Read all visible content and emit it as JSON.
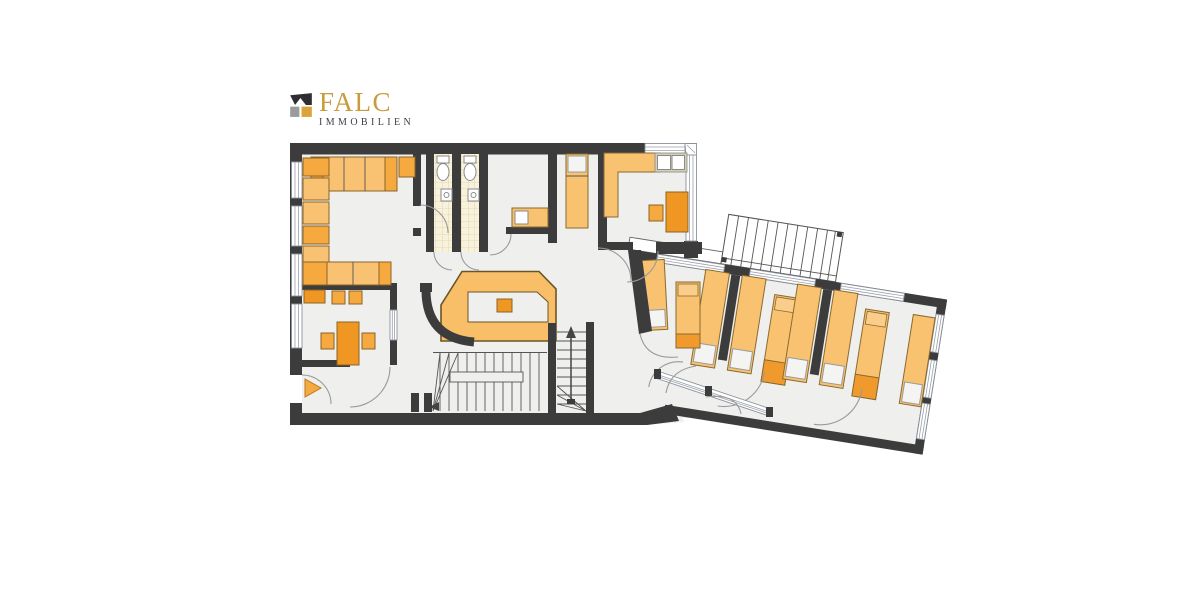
{
  "page": {
    "background": "#FFFFFF",
    "kind": "real-estate floor plan"
  },
  "logo": {
    "brand": "FALC",
    "subtitle": "IMMOBILIEN",
    "brand_color": "#C89B3C",
    "subtitle_color": "#3E3E48",
    "icon": "falc-roof-icon",
    "icon_colors": {
      "roof": "#2E2E34",
      "left_block": "#9B9B9B",
      "right_block": "#D9A43B"
    }
  },
  "floor_plan": {
    "wall_color": "#3C3C3C",
    "floor_color": "#EFEFED",
    "window_color": "#FFFFFF",
    "window_line_color": "#8C929C",
    "tile_color": "#F8F2DC",
    "tile_grid_color": "#DBD1A8",
    "door_arc_color": "#9A9A9A",
    "entrance_arrow_color": "#F5A93F",
    "furniture_colors": {
      "light": "#F9C272",
      "mid": "#F5A93F",
      "dark": "#EF9722",
      "outline": "#8A6428"
    },
    "rooms": [
      {
        "name": "lounge",
        "furniture": [
          "u-shaped-sofa",
          "side-cabinet"
        ]
      },
      {
        "name": "office",
        "furniture": [
          "desk",
          "desk-chairs",
          "wall-chairs",
          "cabinet"
        ]
      },
      {
        "name": "entrance-vestibule",
        "furniture": [
          "entrance-arrow"
        ]
      },
      {
        "name": "wc-left",
        "furniture": [
          "toilet",
          "washbasin"
        ]
      },
      {
        "name": "wc-right",
        "furniture": [
          "toilet",
          "washbasin"
        ]
      },
      {
        "name": "small-room",
        "furniture": [
          "sideboard"
        ]
      },
      {
        "name": "single-bedroom",
        "furniture": [
          "bed"
        ]
      },
      {
        "name": "corner-room",
        "furniture": [
          "l-shaped-counter",
          "desk",
          "chair"
        ]
      },
      {
        "name": "reception-hall",
        "furniture": [
          "reception-counter",
          "radiator"
        ]
      },
      {
        "name": "dorm-1",
        "beds": 3
      },
      {
        "name": "dorm-2",
        "beds": 3
      },
      {
        "name": "dorm-3",
        "beds": 3
      }
    ],
    "stairs": [
      "winder-staircase",
      "straight-staircase-up",
      "exterior-staircase"
    ],
    "bed_count": 9
  }
}
